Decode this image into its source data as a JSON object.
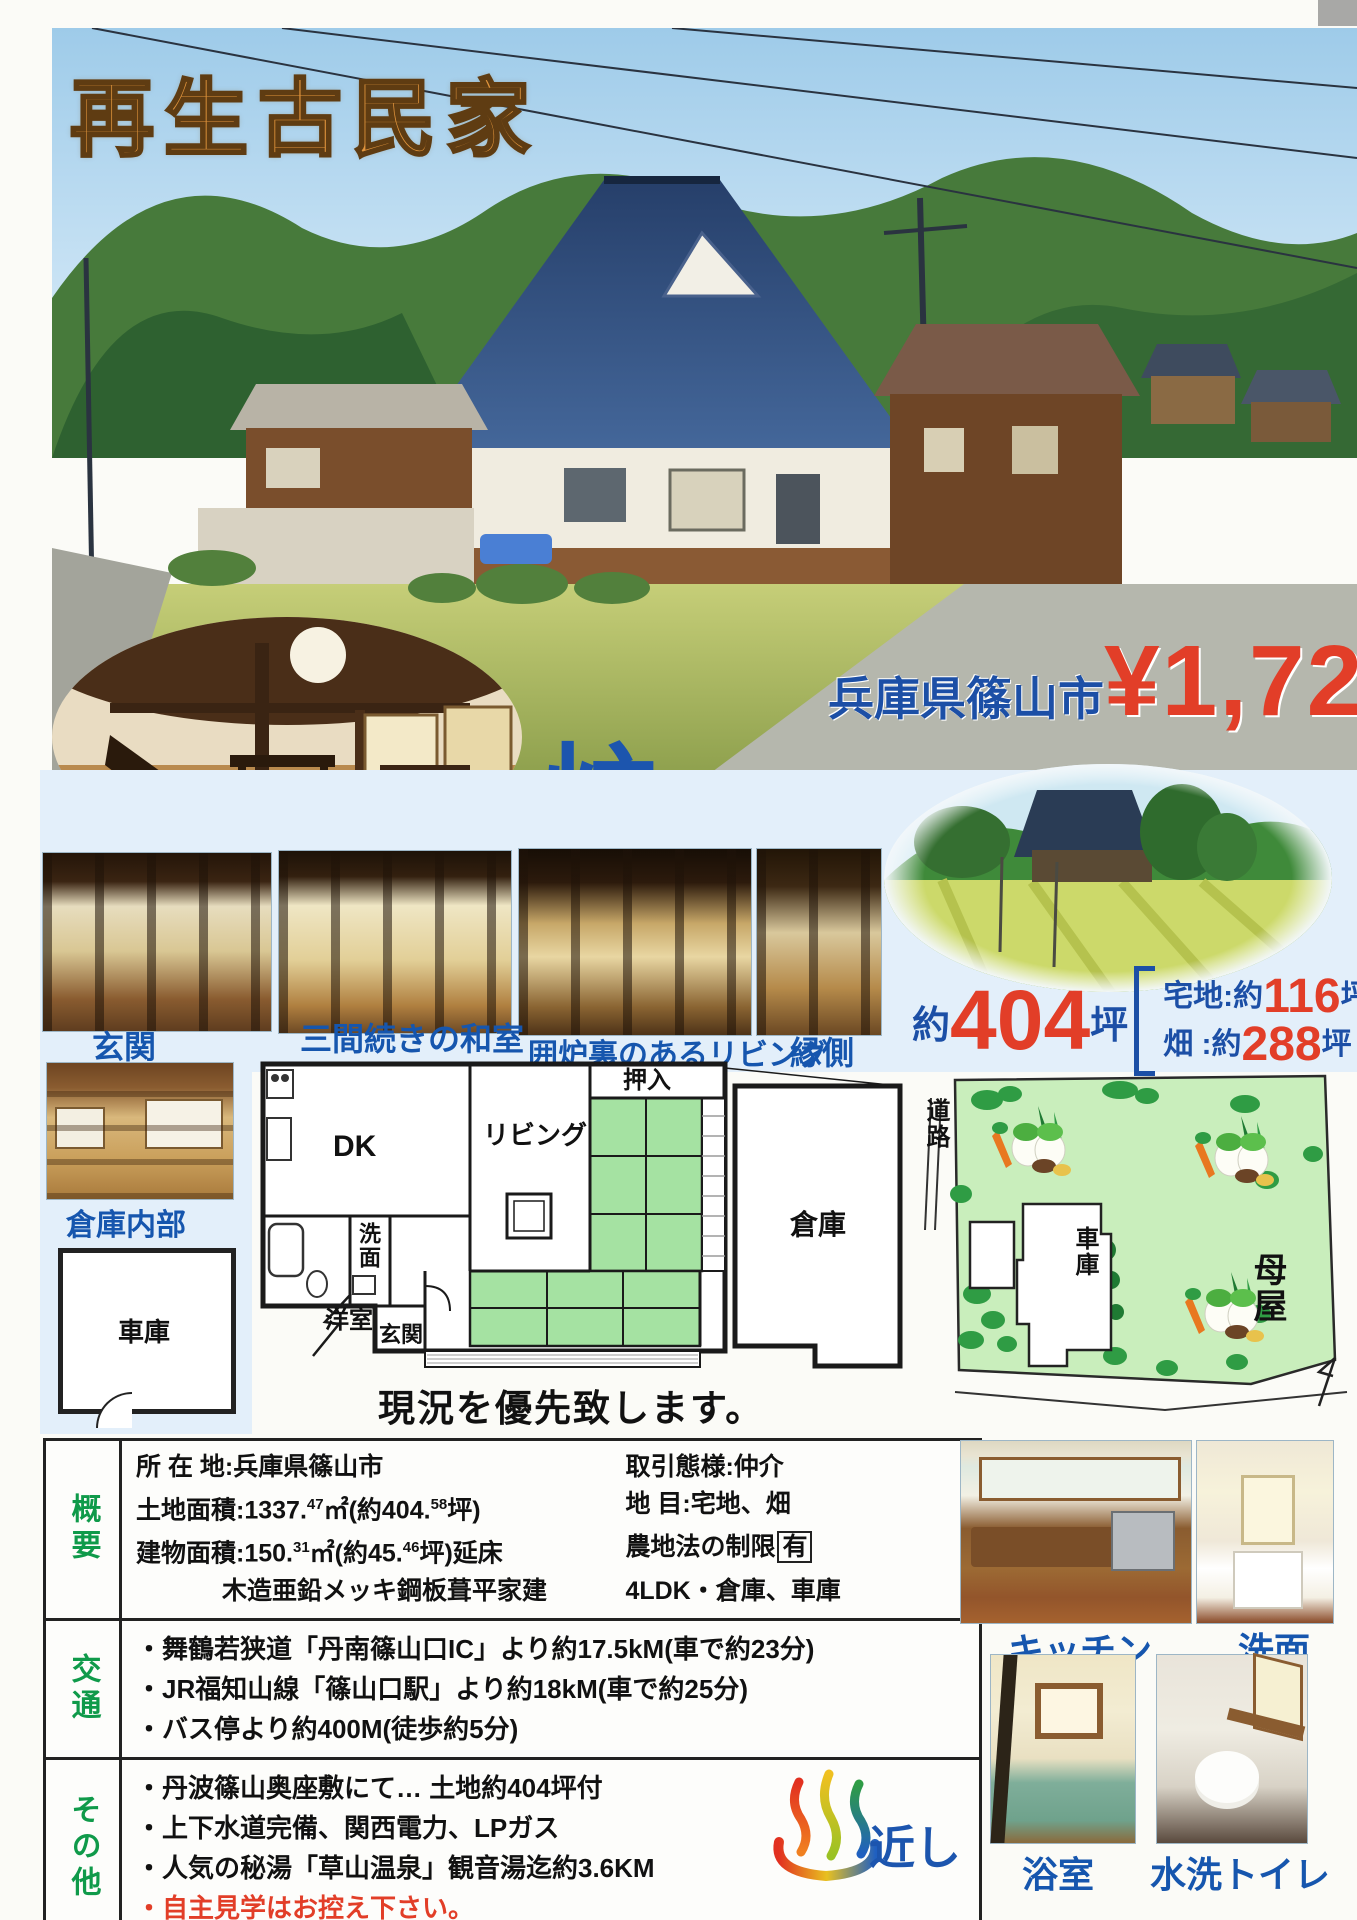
{
  "banner": {
    "title": "再生古民家"
  },
  "hero": {
    "location": "兵庫県篠山市",
    "price_yen": "¥1,729",
    "price_unit": "万円"
  },
  "irori_badge": {
    "small": "囲",
    "big": "炉",
    "rest": "裏付"
  },
  "captions": {
    "genkan": "玄関",
    "washitsu": "三間続きの和室",
    "irori_living": "囲炉裏のあるリビング",
    "engawa": "縁側",
    "warehouse_interior": "倉庫内部",
    "kitchen": "キッチン",
    "washstand": "洗面",
    "bathroom": "浴室",
    "toilet": "水洗トイレ"
  },
  "land_summary": {
    "approx": "約",
    "total": "404",
    "unit": "坪",
    "items": [
      {
        "label": "宅地:約",
        "num": "116",
        "unit": "坪"
      },
      {
        "label": "畑 :約",
        "num": "288",
        "unit": "坪"
      }
    ]
  },
  "floorplan": {
    "dk": "DK",
    "living": "リビング",
    "closet_top": "押入",
    "closet_right": "押入",
    "washroom": "洗面",
    "western_room": "洋室",
    "entrance": "玄関",
    "warehouse": "倉庫",
    "note": "現況を優先致します。"
  },
  "garage_plan": {
    "label": "車庫"
  },
  "sitemap": {
    "road": "道路",
    "garage": "車庫",
    "main_house": "母屋"
  },
  "spec_table": {
    "overview": {
      "header": "概要",
      "address": "所 在 地:兵庫県篠山市",
      "deal": "取引態様:仲介",
      "land": {
        "a": "土地面積:1337.",
        "s1": "47",
        "b": "㎡(約404.",
        "s2": "58",
        "c": "坪)"
      },
      "category": "地   目:宅地、畑",
      "building": {
        "a": "建物面積:150.",
        "s1": "31",
        "b": "㎡(約45.",
        "s2": "46",
        "c": "坪)延床"
      },
      "farmland": {
        "a": "農地法の制限",
        "boxed": "有"
      },
      "structure": "木造亜鉛メッキ鋼板葺平家建",
      "layout": "4LDK・倉庫、車庫"
    },
    "access": {
      "header": "交通",
      "lines": [
        "・舞鶴若狭道「丹南篠山口IC」より約17.5kM(車で約23分)",
        "・JR福知山線「篠山口駅」より約18kM(車で約25分)",
        "・バス停より約400M(徒歩約5分)"
      ]
    },
    "other": {
      "header": "その他",
      "lines": [
        "・丹波篠山奥座敷にて… 土地約404坪付",
        "・上下水道完備、関西電力、LPガス",
        "・人気の秘湯「草山温泉」観音湯迄約3.6KM"
      ],
      "warning": "・自主見学はお控え下さい。",
      "onsen_note": "近し"
    }
  },
  "colors": {
    "caption_blue": "#1656ae",
    "price_red": "#e23e28",
    "location_blue": "#1c4fa6",
    "table_header_green": "#0f9a4a",
    "tatami_green": "#a5e2a2",
    "sitemap_green": "#c9eebc",
    "title_orange": "#e2953d"
  }
}
